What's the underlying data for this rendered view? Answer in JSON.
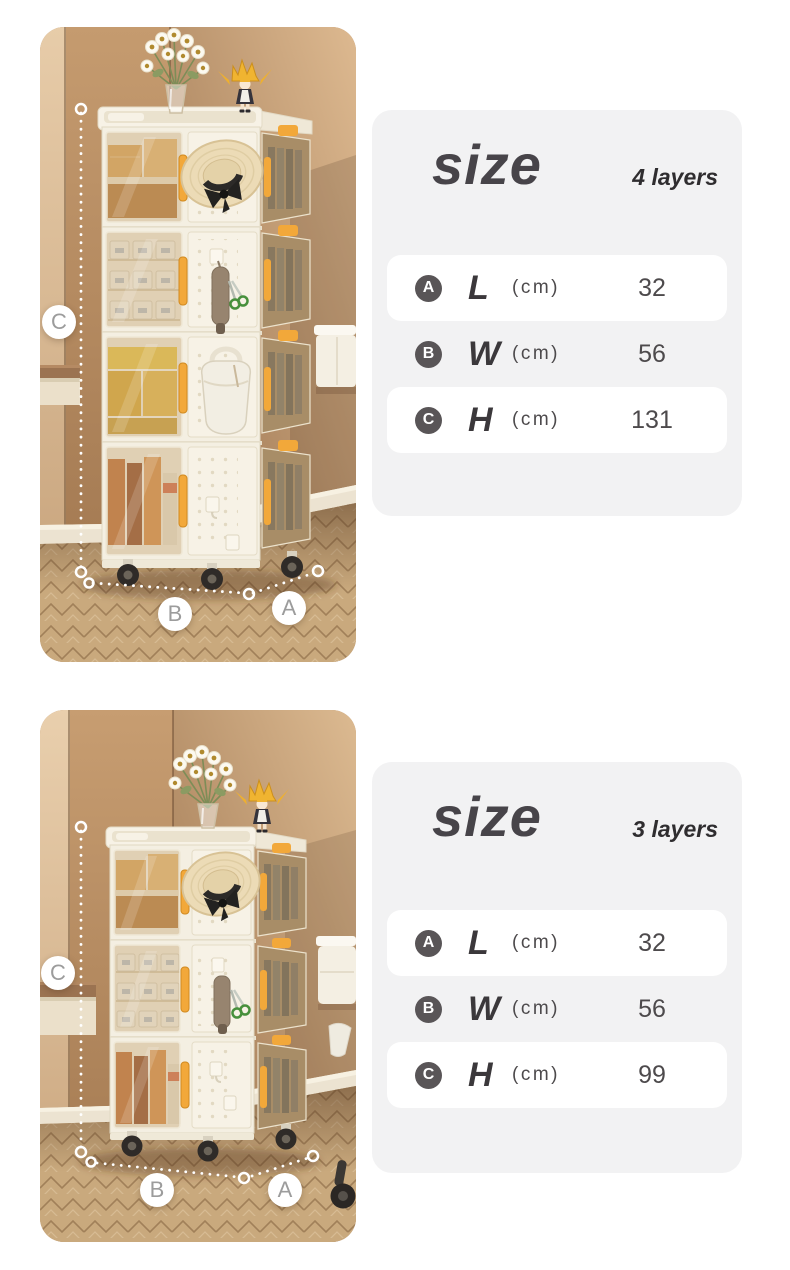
{
  "colors": {
    "accent_yellow": "#f2a83a",
    "panel_bg": "#f2f2f3",
    "badge_bg": "#595557",
    "wall_tan": "#b78d63",
    "floor_wood": "#c9a97d",
    "cabinet_cream": "#f5f0e4",
    "annotation_white": "#ffffff"
  },
  "sections": [
    {
      "id": "four-layer",
      "photo": {
        "alt": "4-layer foldable storage cabinet with wheels in a room corner",
        "labels": {
          "height": "C",
          "width": "B",
          "depth": "A"
        }
      },
      "panel": {
        "title": "size",
        "subtitle": "4 layers",
        "rows": [
          {
            "badge": "A",
            "dim": "L",
            "unit": "(cm)",
            "value": "32"
          },
          {
            "badge": "B",
            "dim": "W",
            "unit": "(cm)",
            "value": "56"
          },
          {
            "badge": "C",
            "dim": "H",
            "unit": "(cm)",
            "value": "131"
          }
        ]
      }
    },
    {
      "id": "three-layer",
      "photo": {
        "alt": "3-layer foldable storage cabinet with wheels in a room corner",
        "labels": {
          "height": "C",
          "width": "B",
          "depth": "A"
        }
      },
      "panel": {
        "title": "size",
        "subtitle": "3 layers",
        "rows": [
          {
            "badge": "A",
            "dim": "L",
            "unit": "(cm)",
            "value": "32"
          },
          {
            "badge": "B",
            "dim": "W",
            "unit": "(cm)",
            "value": "56"
          },
          {
            "badge": "C",
            "dim": "H",
            "unit": "(cm)",
            "value": "99"
          }
        ]
      }
    }
  ]
}
